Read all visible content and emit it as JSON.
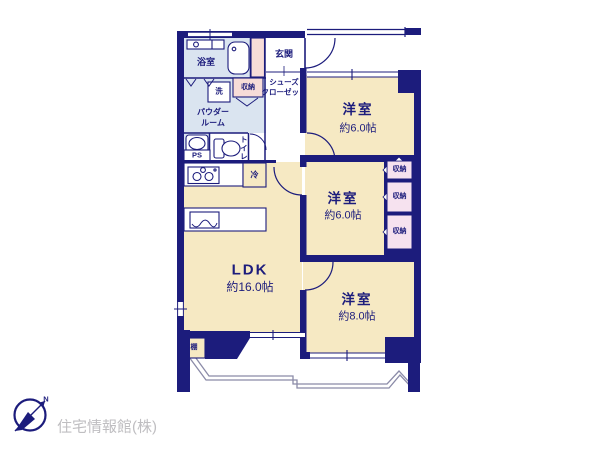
{
  "palette": {
    "navy": "#1c1c7c",
    "cream": "#f6e9c3",
    "lightblue": "#dae4f0",
    "pink": "#f7dcd8",
    "lavender_pink": "#f6e2ef",
    "balcony_line": "#8b8ba8",
    "logo_gray": "#bfbec1",
    "white": "#ffffff"
  },
  "rooms": {
    "bathroom": {
      "label": "浴室"
    },
    "entrance": {
      "label": "玄関"
    },
    "shoe_closet": {
      "label_line1": "シューズ",
      "label_line2": "クローゼット"
    },
    "hall_storage": {
      "label": "収納"
    },
    "laundry": {
      "label": "洗"
    },
    "powder_room": {
      "label_line1": "パウダー",
      "label_line2": "ルーム"
    },
    "pipe_space": {
      "label": "PS"
    },
    "toilet": {
      "label": "トイレ"
    },
    "refrigerator": {
      "label": "冷"
    },
    "ldk": {
      "label": "LDK",
      "size": "約16.0帖"
    },
    "bedroom_top": {
      "label": "洋室",
      "size": "約6.0帖"
    },
    "bedroom_middle": {
      "label": "洋室",
      "size": "約6.0帖"
    },
    "bedroom_bottom": {
      "label": "洋室",
      "size": "約8.0帖"
    },
    "closet_1": {
      "label": "収納"
    },
    "closet_2": {
      "label": "収納"
    },
    "closet_3": {
      "label": "収納"
    },
    "shelf": {
      "label": "棚"
    }
  },
  "footer": {
    "company": "住宅情報館(株)",
    "compass_north": "N"
  }
}
